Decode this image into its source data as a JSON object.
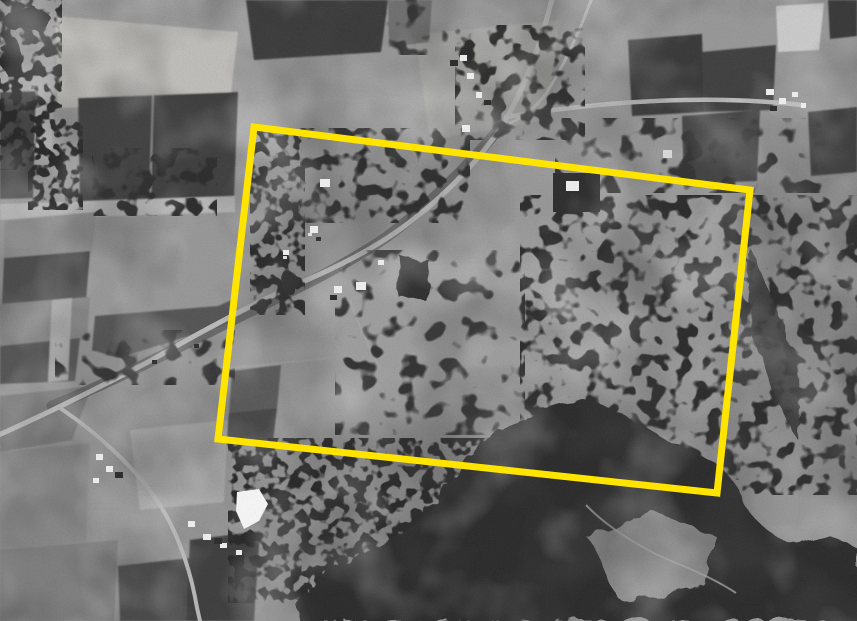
{
  "canvas": {
    "width": 857,
    "height": 621
  },
  "scene": {
    "type": "black-and-white aerial photograph",
    "description": "Vertical aerial photograph of farmland: rectangular crop fields in light and dark tones, a diagonal road running from the top centre down to the left edge, several farmsteads with small white-roofed buildings, scattered scrub trees, a square dark tree plantation with a building at its centre, a large dark forest block in the lower right with a pale clearing, and a bright white pond near the lower left.",
    "palette": {
      "base_gray": "#979797",
      "light_field": "#c0bfbc",
      "dark_field": "#3f3f3f",
      "forest": "#2d2d2d",
      "road": "#bababa",
      "building": "#ededed",
      "pond": "#f4f4f4"
    }
  },
  "overlay": {
    "label": "highlighted-area-boundary",
    "shape": "rotated-rectangle",
    "color": "#ffe400",
    "stroke_width": 7,
    "corners": [
      [
        254,
        127
      ],
      [
        750,
        190
      ],
      [
        717,
        493
      ],
      [
        218,
        439
      ]
    ]
  }
}
